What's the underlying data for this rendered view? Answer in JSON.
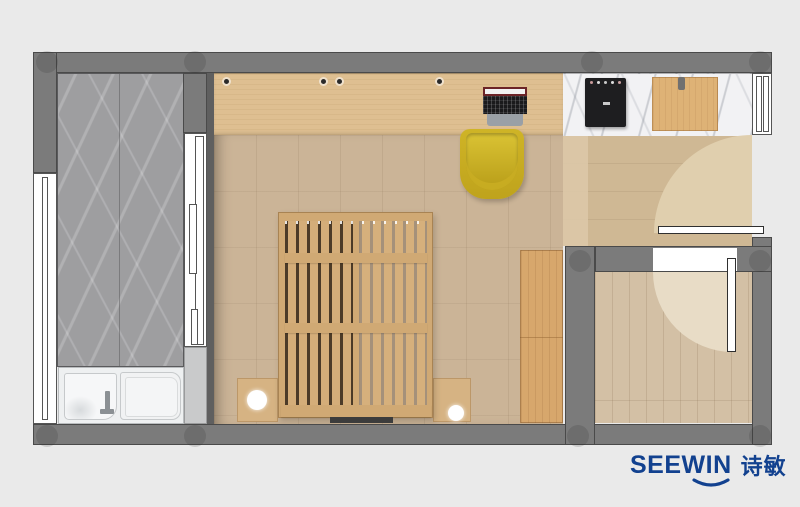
{
  "logo": {
    "brand_latin": "SEEWIN",
    "brand_cjk": "诗敏",
    "color": "#12418f"
  },
  "palette": {
    "background": "#eaeaea",
    "wall": "#7b7b7b",
    "wood_floor": "#cbb497",
    "desk_wood": "#debf91",
    "bed_wood": "#d0a974",
    "wardrobe_wood": "#d7a76c",
    "marble_bath": "#9e9ea0",
    "marble_counter": "#f2f2f4",
    "chair_yellow": "#c9ad22",
    "fixture_white": "#f2f3f4",
    "logo_blue": "#12418f"
  }
}
